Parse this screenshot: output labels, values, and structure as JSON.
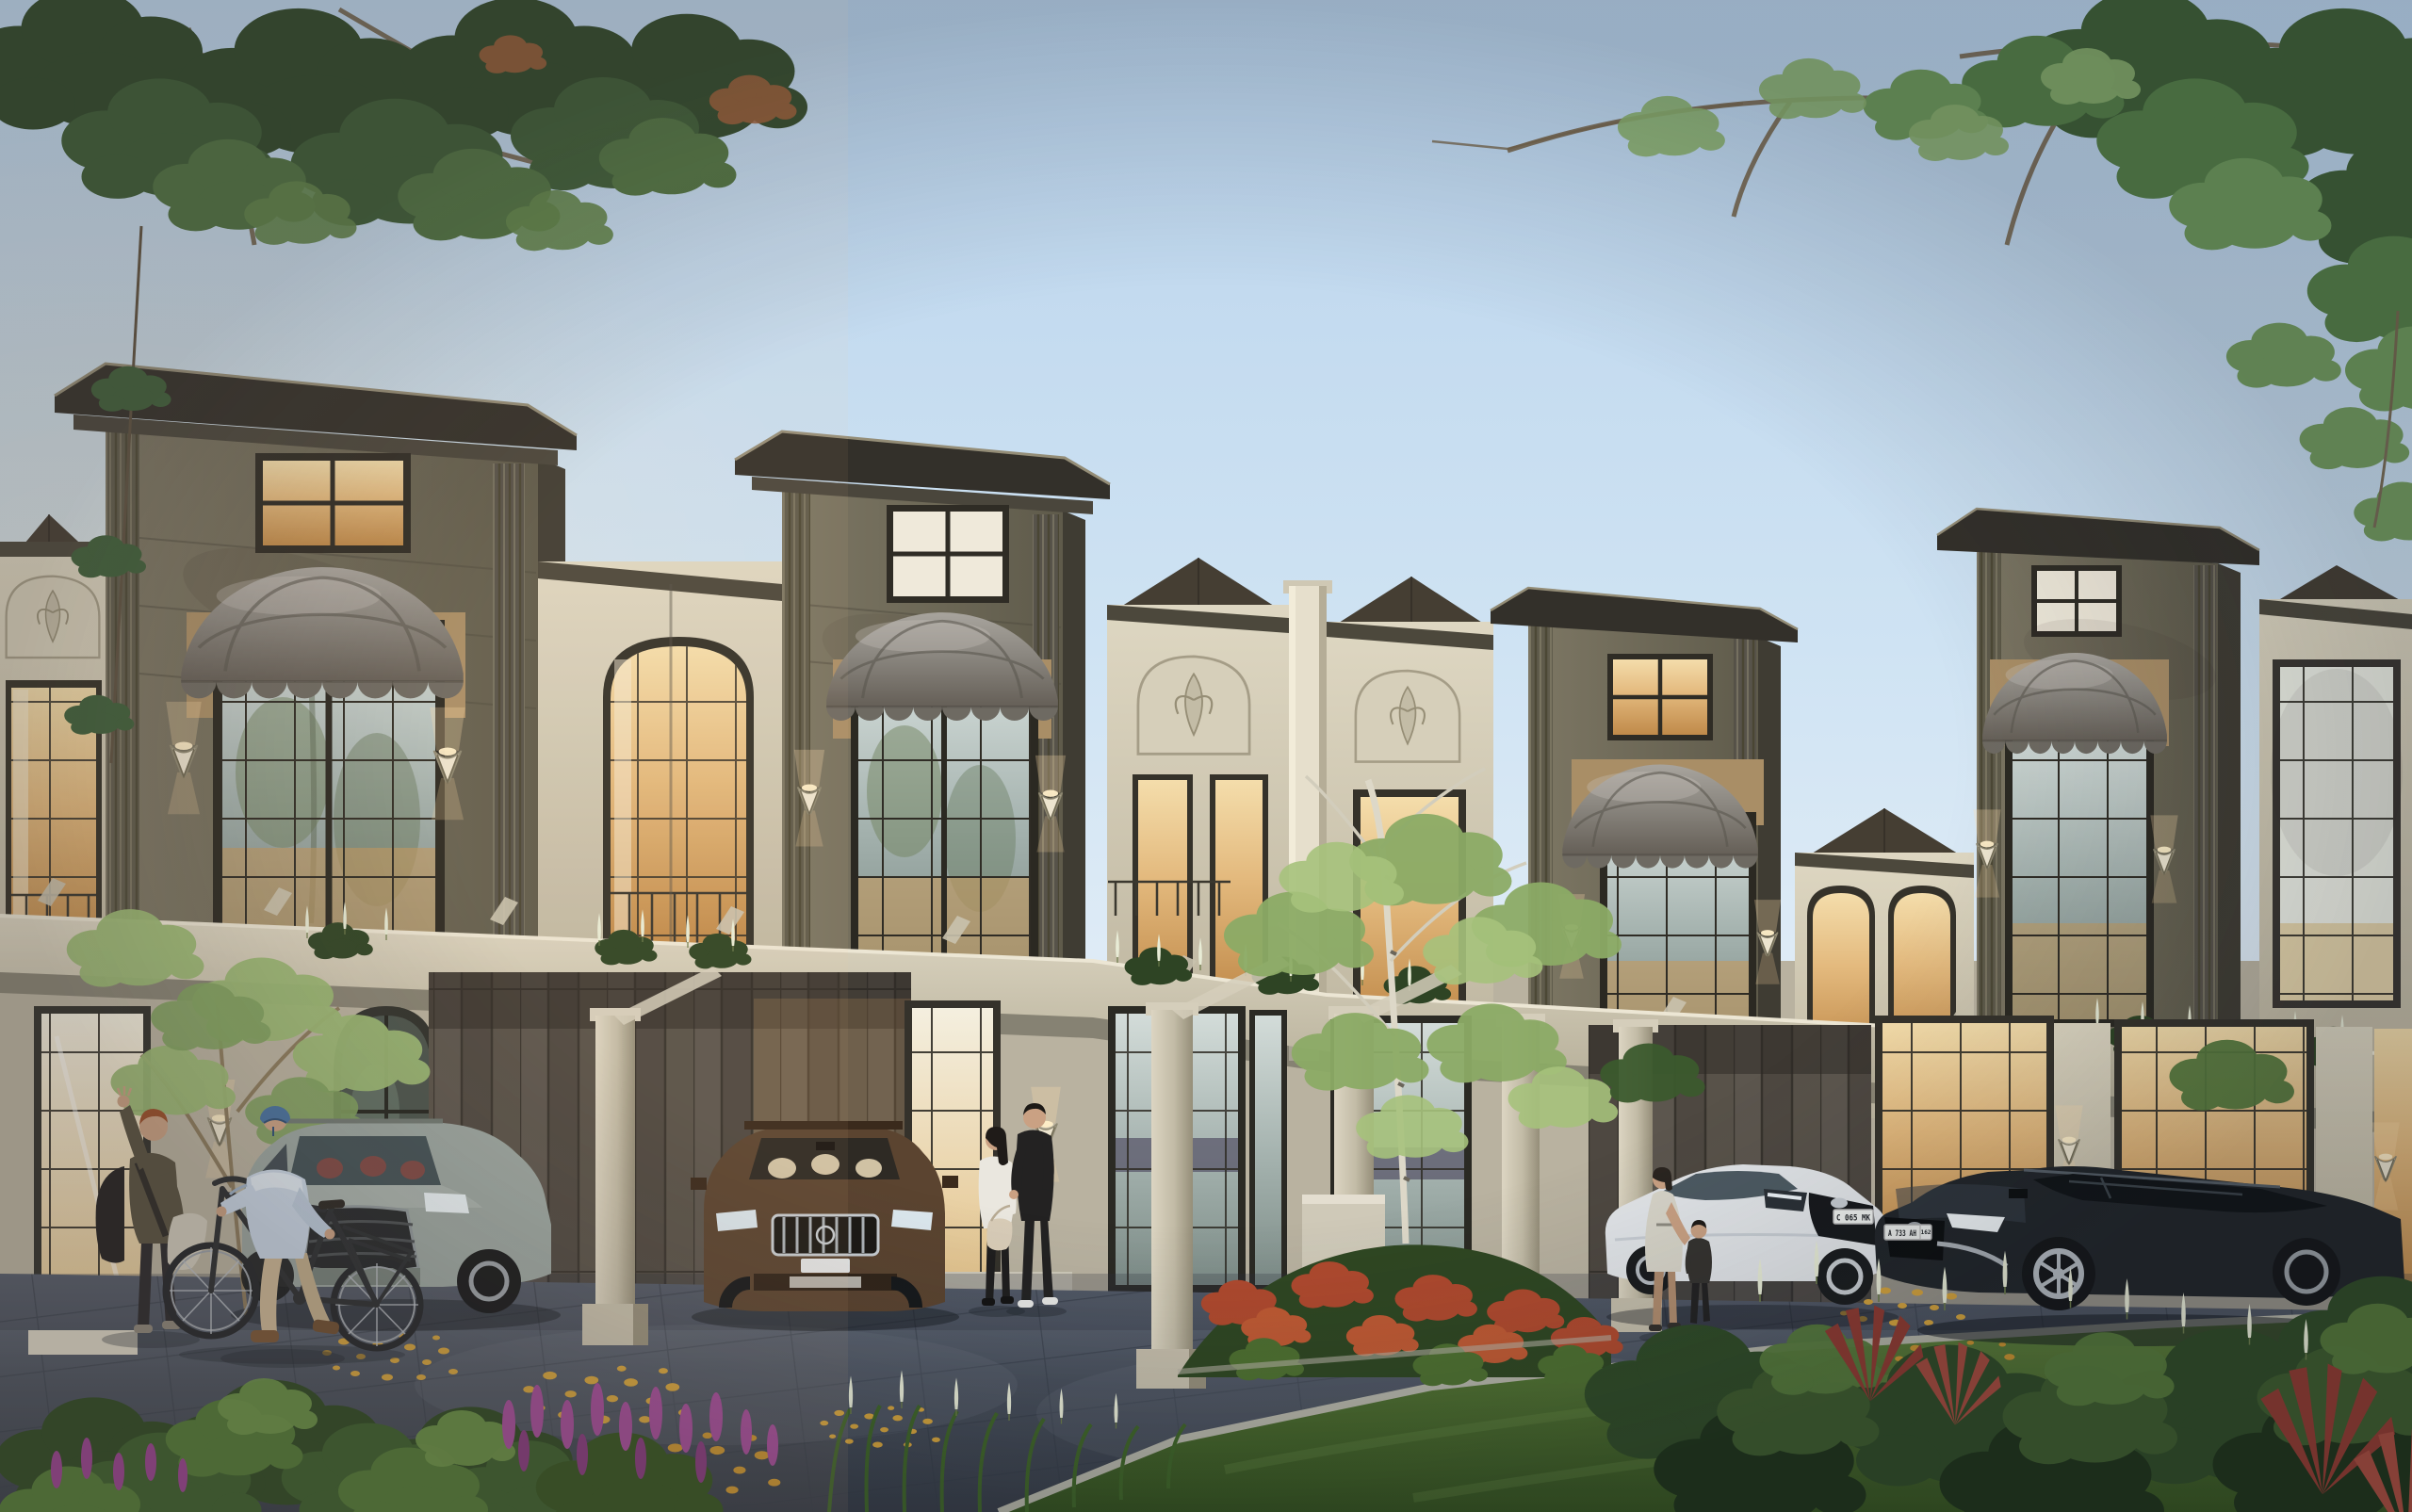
{
  "scene": {
    "kind": "photorealistic 3D architectural exterior rendering",
    "subject": "Row of two-storey modern-classic townhouses with bay towers, dome awnings and stone carport pergolas",
    "time_of_day": "golden hour, facade sconces and interior lights on",
    "sky": "clear pale-blue sky with overhanging tree canopies in both top corners",
    "camera": "street-level front elevation view"
  },
  "palette": {
    "sky_top": "#b9d3ec",
    "sky_horizon": "#e9f1f8",
    "tower_face": "#6e6959",
    "cornice": "#3a372e",
    "cream_wall": "#d9d2bd",
    "shingle": "#453e33",
    "awning": "#8b8780",
    "awning_valance": "#6e6a62",
    "stone": "#c9c2ae",
    "plank_wall": "#544e47",
    "glass_warm": "#e3b97d",
    "glass_dusk": "#a2b0ac",
    "mullion": "#2f2c25",
    "pavement": "#49505c",
    "lawn": "#44642c",
    "foliage_dark": "#33512c",
    "foliage_light": "#7fa261",
    "leaf_litter": "#d4a33c",
    "flower_purple": "#a14b97",
    "flower_red": "#b04a2e",
    "flower_white": "#e8ecd6",
    "sconce_glow": "#ffdfae",
    "skin": "#caa183"
  },
  "architecture": {
    "tower_count": 4,
    "tower_style": "olive-grey bay towers with flared cornice caps and fluted pilasters",
    "attic_windows": "small four-pane windows at the tower tops",
    "bay_windows": "tall black-mullion French windows over two storeys",
    "awnings": "grey fabric dome awnings with scalloped valance",
    "ornament": "cream stucco bays with arched acanthus-relief panels",
    "roofs": "dark fish-scale shingle hips between towers",
    "lighting": "lit torch-style wall sconces flanking windows and doors",
    "ground_floor": "stone pergola carports, dark plank-tile garage walls, warm-lit full-height glazing",
    "balconies": "planter boxes with white flowers and wrought-iron railings"
  },
  "vehicles": {
    "sage_suv": {
      "type": "crossover SUV",
      "color_name": "sage grey",
      "hex": "#9aa5a0",
      "position": "left carport behind the cyclists",
      "details": "dark mesh grille, red-brown interior"
    },
    "brown_suv": {
      "type": "SUV",
      "color_name": "mahogany brown",
      "hex": "#5b4430",
      "position": "centre carport, frontal view",
      "details": "chrome vertical-slat grille, cream interior, blank plate"
    },
    "white_sedan": {
      "type": "sedan",
      "color_name": "white",
      "hex": "#e2e5e8",
      "plate": "C 065 MK",
      "position": "right driveway beside woman and child"
    },
    "black_wagon": {
      "type": "cross wagon",
      "color_name": "black",
      "hex": "#212529",
      "plate": "A 733 AH",
      "plate_region": "162",
      "position": "right driveway, foreground"
    }
  },
  "people": {
    "waving_man": "red-haired man in olive top with black backpack, right hand raised, jacket in left hand",
    "cyclist": "man in blue helmet and light-blue long sleeve standing over a city bicycle",
    "couple_man": "tall man dressed in black with white sneakers at the entry",
    "couple_woman": "dark-haired woman in white blouse with cream handbag",
    "mother": "woman in a light summer dress by the white sedan",
    "child": "child in dark clothes beside her"
  },
  "landscape": {
    "trees": [
      "dark oak canopy overhanging top-left",
      "sunlit canopy with long bare branch top-right",
      "young birch with sparse light foliage at centre",
      "slender sapling by the left facade"
    ],
    "beds": [
      "red-orange shrub bed along the drive",
      "purple salvia spikes bottom-left",
      "white bottlebrush spikes in the right shrubs",
      "red cordyline fans",
      "lawn strip behind the front shrubs"
    ],
    "ground": "dark grey paver driveway with scattered yellow autumn leaves"
  }
}
